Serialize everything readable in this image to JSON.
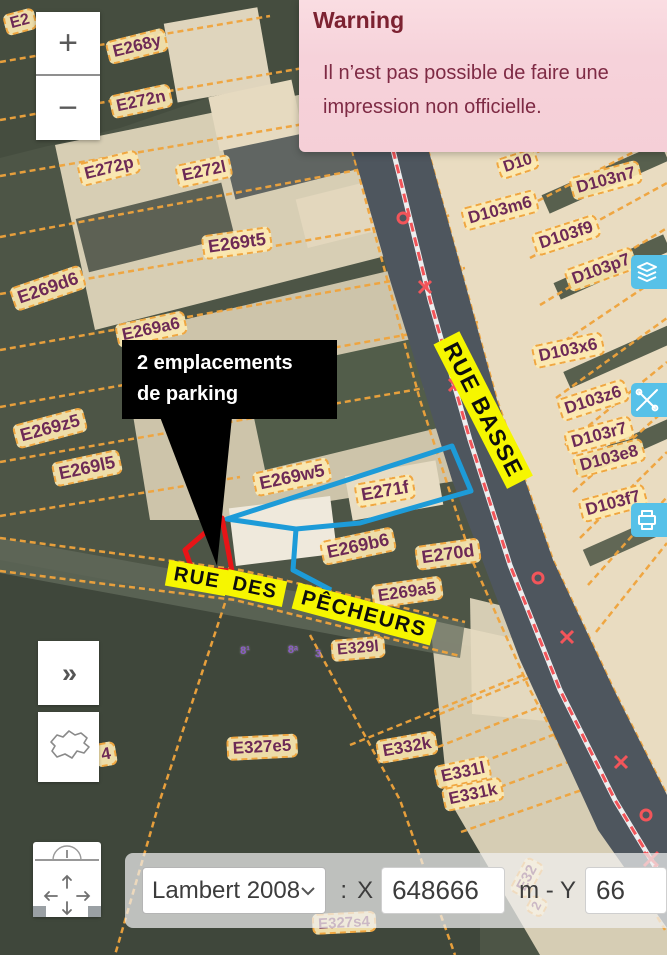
{
  "warning": {
    "title": "Warning",
    "message": "Il n’est pas possible de faire une impression non officielle."
  },
  "zoom_controls": {
    "zoom_in": "+",
    "zoom_out": "−"
  },
  "left_controls": {
    "expand_label": "»"
  },
  "side_buttons": [
    {
      "icon": "layers-icon"
    },
    {
      "icon": "tools-icon"
    },
    {
      "icon": "printer-icon"
    }
  ],
  "coordinate_bar": {
    "projection": "Lambert 2008",
    "separator": ":",
    "x_label": "X",
    "x_value": "648666",
    "unit_label": "m - Y",
    "y_value": "66"
  },
  "callout": {
    "line1": "2 emplacements",
    "line2": "de parking"
  },
  "street_labels": [
    {
      "t": "RUE BASSE",
      "x": 483,
      "y": 410,
      "r": 63,
      "s": 23
    },
    {
      "t": "RUE",
      "x": 197,
      "y": 578,
      "r": 10,
      "s": 20
    },
    {
      "t": "DES",
      "x": 255,
      "y": 588,
      "r": 12,
      "s": 20
    },
    {
      "t": "PÊCHEURS",
      "x": 364,
      "y": 614,
      "r": 15,
      "s": 21
    }
  ],
  "parcel_labels": [
    {
      "t": "E2",
      "x": 20,
      "y": 22,
      "r": -15,
      "s": 16
    },
    {
      "t": "E268y",
      "x": 137,
      "y": 46,
      "r": -14,
      "s": 17
    },
    {
      "t": "E272n",
      "x": 141,
      "y": 101,
      "r": -12,
      "s": 17
    },
    {
      "t": "E272p",
      "x": 109,
      "y": 168,
      "r": -14,
      "s": 17
    },
    {
      "t": "E272l",
      "x": 204,
      "y": 171,
      "r": -12,
      "s": 17
    },
    {
      "t": "E269t5",
      "x": 237,
      "y": 243,
      "r": -8,
      "s": 18
    },
    {
      "t": "E269d6",
      "x": 48,
      "y": 288,
      "r": -19,
      "s": 18
    },
    {
      "t": "E269a6",
      "x": 151,
      "y": 329,
      "r": -12,
      "s": 17
    },
    {
      "t": "E269z5",
      "x": 50,
      "y": 428,
      "r": -15,
      "s": 18
    },
    {
      "t": "E269l5",
      "x": 87,
      "y": 468,
      "r": -12,
      "s": 18
    },
    {
      "t": "E269w5",
      "x": 292,
      "y": 477,
      "r": -12,
      "s": 18
    },
    {
      "t": "E271f",
      "x": 385,
      "y": 491,
      "r": -10,
      "s": 18
    },
    {
      "t": "E269b6",
      "x": 358,
      "y": 546,
      "r": -12,
      "s": 18
    },
    {
      "t": "E270d",
      "x": 448,
      "y": 554,
      "r": -8,
      "s": 18
    },
    {
      "t": "E269a5",
      "x": 407,
      "y": 592,
      "r": -8,
      "s": 17
    },
    {
      "t": "E329l",
      "x": 358,
      "y": 649,
      "r": -5,
      "s": 16
    },
    {
      "t": "E327e5",
      "x": 262,
      "y": 747,
      "r": -3,
      "s": 17
    },
    {
      "t": "E332k",
      "x": 407,
      "y": 747,
      "r": -10,
      "s": 17
    },
    {
      "t": "E331l",
      "x": 463,
      "y": 772,
      "r": -12,
      "s": 17
    },
    {
      "t": "E331k",
      "x": 473,
      "y": 794,
      "r": -12,
      "s": 17
    },
    {
      "t": "4",
      "x": 106,
      "y": 754,
      "r": -10,
      "s": 17
    },
    {
      "t": "E327s4",
      "x": 344,
      "y": 923,
      "r": -3,
      "s": 15
    },
    {
      "t": "E32",
      "x": 527,
      "y": 878,
      "r": -62,
      "s": 15
    },
    {
      "t": "2",
      "x": 537,
      "y": 906,
      "r": -62,
      "s": 13
    },
    {
      "t": "D10",
      "x": 518,
      "y": 164,
      "r": -18,
      "s": 16
    },
    {
      "t": "D103n7",
      "x": 606,
      "y": 180,
      "r": -15,
      "s": 17
    },
    {
      "t": "D103m6",
      "x": 500,
      "y": 210,
      "r": -15,
      "s": 17
    },
    {
      "t": "D103f9",
      "x": 566,
      "y": 235,
      "r": -18,
      "s": 17
    },
    {
      "t": "D103p7",
      "x": 601,
      "y": 269,
      "r": -20,
      "s": 17
    },
    {
      "t": "D103x6",
      "x": 568,
      "y": 350,
      "r": -12,
      "s": 17
    },
    {
      "t": "D103z6",
      "x": 593,
      "y": 400,
      "r": -18,
      "s": 17
    },
    {
      "t": "D103r7",
      "x": 599,
      "y": 435,
      "r": -15,
      "s": 17
    },
    {
      "t": "D103e8",
      "x": 609,
      "y": 458,
      "r": -15,
      "s": 17
    },
    {
      "t": "D103f7",
      "x": 613,
      "y": 503,
      "r": -15,
      "s": 17
    }
  ],
  "house_marks": [
    {
      "t": "8¹",
      "x": 245,
      "y": 651,
      "r": 0,
      "s": 11
    },
    {
      "t": "8ᵃ",
      "x": 293,
      "y": 650,
      "r": 0,
      "s": 11
    },
    {
      "t": "3",
      "x": 318,
      "y": 654,
      "r": 0,
      "s": 11
    }
  ],
  "colors": {
    "parcel_line": "#f0a43c",
    "parcel_text": "#6d2a56",
    "parcel_bg": "#fce9b2",
    "street_bg": "#f6f600",
    "selection_blue": "#1d9bd8",
    "highlight_red": "#e81417",
    "side_button_blue": "#57c1e8",
    "warning_bg": "#f6d2da",
    "warning_text": "#7c2231",
    "road": "#4e565e",
    "forest": "#4d5546",
    "building": "#e8dcc4"
  }
}
